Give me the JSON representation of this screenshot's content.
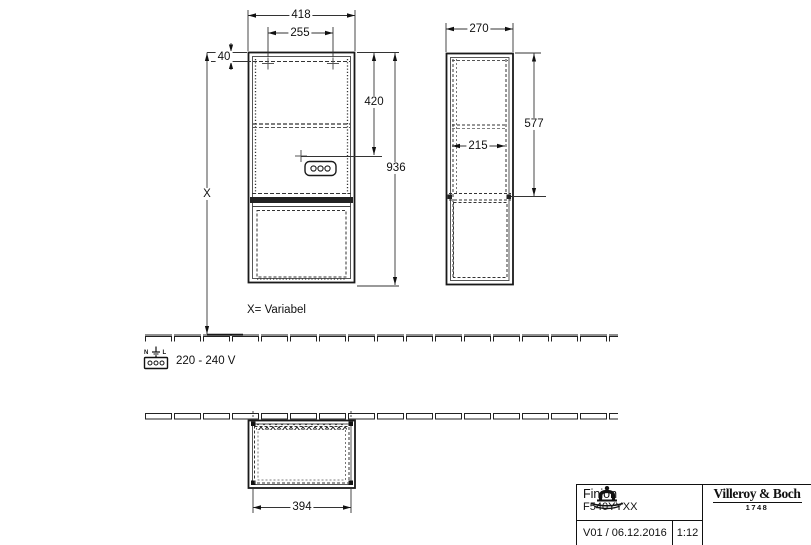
{
  "front_view": {
    "width": "418",
    "hole_spacing": "255",
    "hole_offset": "40",
    "socket_height": "420",
    "total_height": "936",
    "height_variable": "X",
    "variable_note": "X= Variabel"
  },
  "side_view": {
    "depth": "270",
    "upper_height": "577",
    "inner_depth": "215"
  },
  "plan_view": {
    "body_width": "394"
  },
  "power": {
    "voltage": "220 - 240 V",
    "neutral": "N",
    "line": "L"
  },
  "title_block": {
    "product": "Finion",
    "article": "F540YYXX",
    "version": "V01 / 06.12.2016",
    "scale": "1:12",
    "brand": "Villeroy & Boch",
    "year": "1748"
  },
  "colors": {
    "line": "#1a1a1a",
    "background": "#ffffff"
  }
}
